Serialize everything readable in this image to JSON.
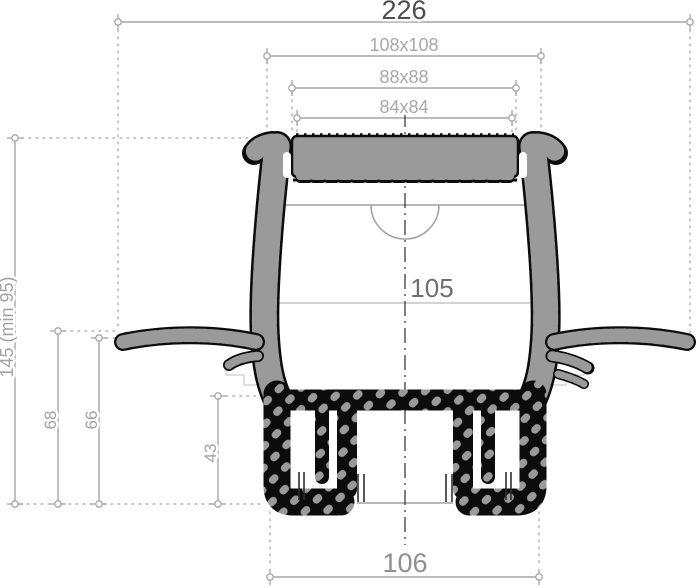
{
  "drawing": {
    "dims": {
      "overall_width": "226",
      "frame_outer": "108x108",
      "frame_mid": "88x88",
      "grate": "84x84",
      "bowl_width": "105",
      "overall_height": "145 (min 95)",
      "flange_top_height": "68",
      "membrane_height": "66",
      "outlet_height": "43",
      "outlet_width": "106"
    },
    "colors": {
      "background": "#ffffff",
      "dimension_line": "#a6a6a6",
      "extension_line": "#b3b3b3",
      "dimension_text_dark": "#4d4d4d",
      "dimension_text_light": "#a8a8a8",
      "body_black": "#0c0c0c",
      "body_grey": "#9a9a9a",
      "centerline": "#2b2b2b"
    }
  }
}
